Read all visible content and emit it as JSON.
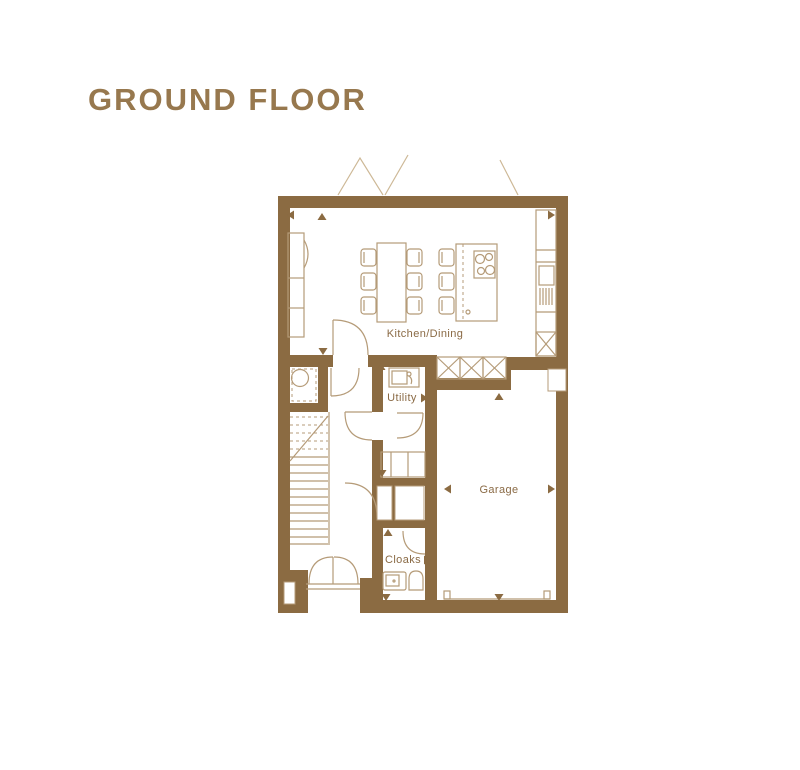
{
  "title": "GROUND FLOOR",
  "plan": {
    "rooms": [
      {
        "id": "kitchen-dining",
        "label": "Kitchen/Dining"
      },
      {
        "id": "utility",
        "label": "Utility"
      },
      {
        "id": "garage",
        "label": "Garage"
      },
      {
        "id": "cloaks",
        "label": "Cloaks"
      }
    ],
    "colors": {
      "wall": "#8B6B42",
      "line": "#B59B78",
      "text": "#8A6A45",
      "title": "#97784E",
      "roof": "#CDB896"
    }
  }
}
